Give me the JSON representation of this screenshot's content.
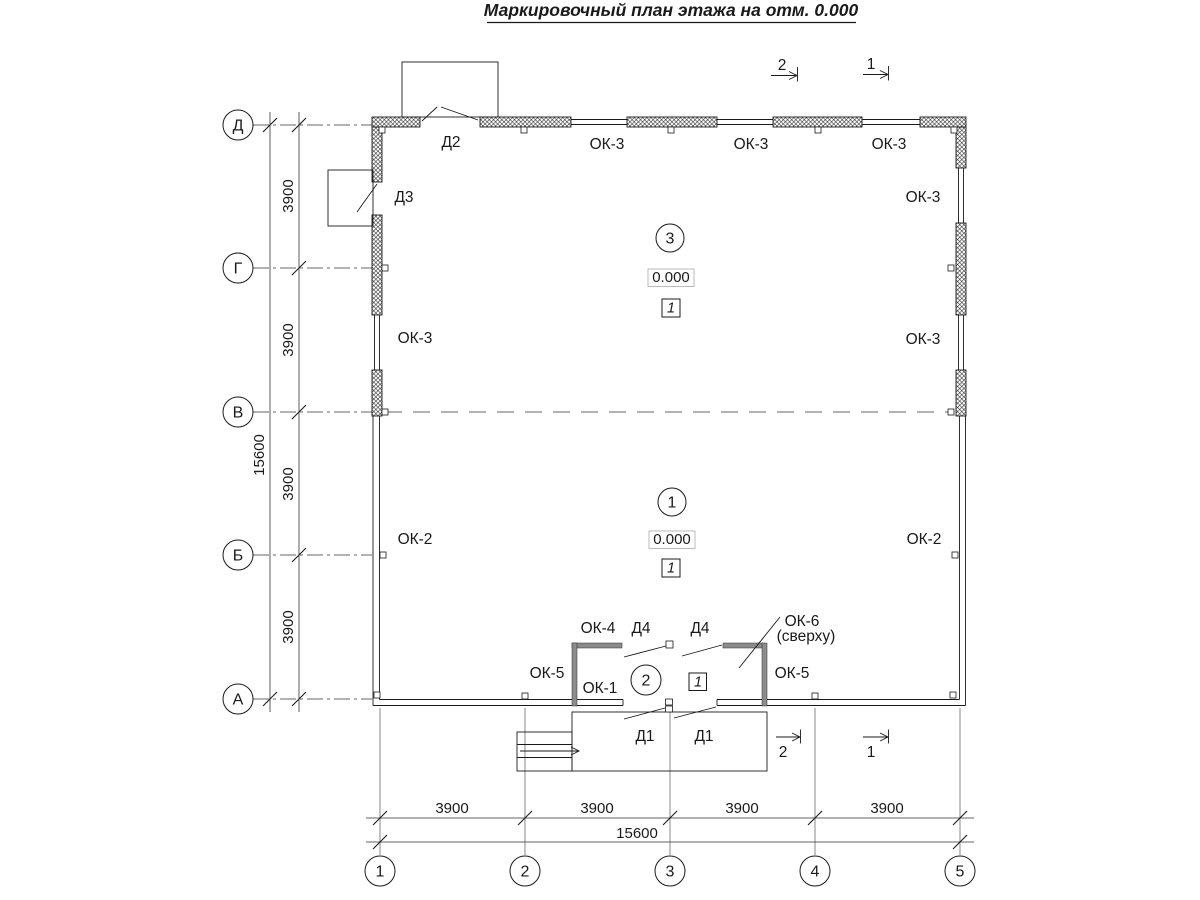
{
  "title": "Маркировочный план этажа на отм. 0.000",
  "axes": {
    "rows": [
      {
        "label": "Д"
      },
      {
        "label": "Г"
      },
      {
        "label": "В"
      },
      {
        "label": "Б"
      },
      {
        "label": "А"
      }
    ],
    "cols": [
      {
        "label": "1"
      },
      {
        "label": "2"
      },
      {
        "label": "3"
      },
      {
        "label": "4"
      },
      {
        "label": "5"
      }
    ]
  },
  "dimensions": {
    "left": {
      "segments": [
        {
          "value": "3900"
        },
        {
          "value": "3900"
        },
        {
          "value": "3900"
        },
        {
          "value": "3900"
        }
      ],
      "total": "15600"
    },
    "bottom": {
      "segments": [
        {
          "value": "3900"
        },
        {
          "value": "3900"
        },
        {
          "value": "3900"
        },
        {
          "value": "3900"
        }
      ],
      "total": "15600"
    }
  },
  "sections": {
    "top": [
      {
        "number": "2"
      },
      {
        "number": "1"
      }
    ],
    "bottom": [
      {
        "number": "2"
      },
      {
        "number": "1"
      }
    ]
  },
  "rooms": [
    {
      "number": "3",
      "elevation": "0.000",
      "finish_mark": "1"
    },
    {
      "number": "1",
      "elevation": "0.000",
      "finish_mark": "1"
    },
    {
      "number": "2",
      "finish_mark": "1"
    }
  ],
  "openings": {
    "door_d2": "Д2",
    "door_d3": "Д3",
    "door_d4_left": "Д4",
    "door_d4_right": "Д4",
    "door_d1_left": "Д1",
    "door_d1_right": "Д1",
    "window_ok3_top_1": "ОК-3",
    "window_ok3_top_2": "ОК-3",
    "window_ok3_top_3": "ОК-3",
    "window_ok3_right_upper": "ОК-3",
    "window_ok3_left": "ОК-3",
    "window_ok3_right": "ОК-3",
    "window_ok2_left": "ОК-2",
    "window_ok2_right": "ОК-2",
    "window_ok4": "ОК-4",
    "window_ok5_left": "ОК-5",
    "window_ok5_right": "ОК-5",
    "window_ok1": "ОК-1",
    "window_ok6": "ОК-6",
    "window_ok6_note": "(сверху)"
  }
}
